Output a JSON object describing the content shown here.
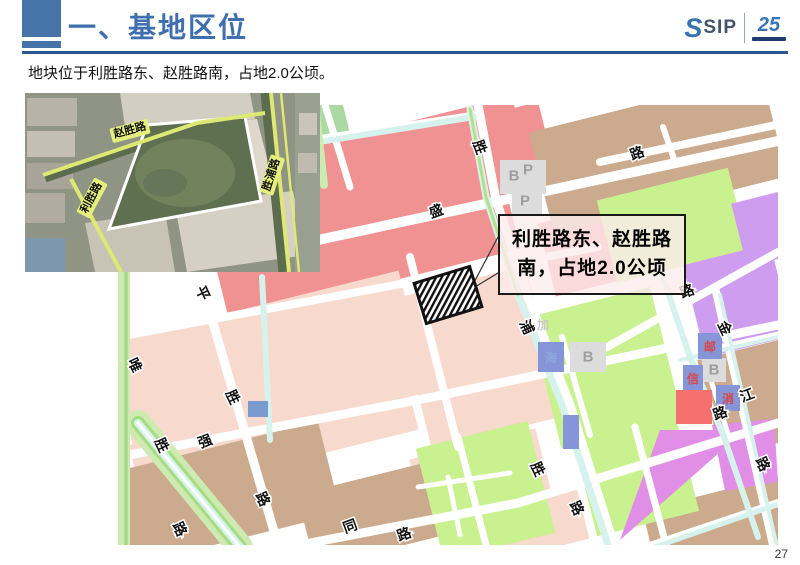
{
  "page": {
    "number": "27"
  },
  "header": {
    "title": "一、基地区位",
    "logo_sip": "SIP",
    "logo_s": "S",
    "logo_anniversary": "25"
  },
  "intro": "地块位于利胜路东、赵胜路南，占地2.0公顷。",
  "callout": {
    "line1": "利胜路东、赵胜路",
    "line2": "南，占地2.0公顷"
  },
  "colors": {
    "accent_blue": "#4673a8",
    "underline_blue": "#2e5492",
    "satellite_label_bg": "#e4ef7d"
  },
  "satellite_labels": [
    {
      "text": "赵胜路",
      "x": 105,
      "y": 38,
      "rot": -15
    },
    {
      "text": "利胜路",
      "x": 67,
      "y": 105,
      "rot": -62
    },
    {
      "text": "胜浦路",
      "x": 247,
      "y": 82,
      "rot": -72
    }
  ],
  "map_labels": {
    "roads": [
      {
        "t": "胜",
        "x": 362,
        "y": 42,
        "r": 70
      },
      {
        "t": "盛",
        "x": 318,
        "y": 106,
        "r": -20
      },
      {
        "t": "路",
        "x": 519,
        "y": 48,
        "r": -20
      },
      {
        "t": "平",
        "x": 85,
        "y": 188,
        "r": 65
      },
      {
        "t": "唯",
        "x": 17,
        "y": 260,
        "r": 65
      },
      {
        "t": "胜",
        "x": 115,
        "y": 292,
        "r": 65
      },
      {
        "t": "强",
        "x": 87,
        "y": 336,
        "r": -20
      },
      {
        "t": "胜",
        "x": 44,
        "y": 340,
        "r": 65
      },
      {
        "t": "路",
        "x": 145,
        "y": 394,
        "r": 65
      },
      {
        "t": "路",
        "x": 62,
        "y": 424,
        "r": 65
      },
      {
        "t": "同",
        "x": 232,
        "y": 421,
        "r": -20
      },
      {
        "t": "路",
        "x": 286,
        "y": 429,
        "r": -20
      },
      {
        "t": "浦",
        "x": 409,
        "y": 222,
        "r": 65
      },
      {
        "t": "胜",
        "x": 420,
        "y": 364,
        "r": 65
      },
      {
        "t": "路",
        "x": 459,
        "y": 403,
        "r": 65
      },
      {
        "t": "路",
        "x": 569,
        "y": 186,
        "r": -20
      },
      {
        "t": "金",
        "x": 607,
        "y": 223,
        "r": 65
      },
      {
        "t": "江",
        "x": 629,
        "y": 290,
        "r": -20
      },
      {
        "t": "路",
        "x": 602,
        "y": 308,
        "r": -20
      },
      {
        "t": "路",
        "x": 645,
        "y": 359,
        "r": 65
      }
    ],
    "areas": [
      {
        "t": "B",
        "x": 396,
        "y": 71
      },
      {
        "t": "P",
        "x": 410,
        "y": 65
      },
      {
        "t": "P",
        "x": 407,
        "y": 96
      },
      {
        "t": "B",
        "x": 470,
        "y": 252
      },
      {
        "t": "B",
        "x": 596,
        "y": 265
      }
    ],
    "facilities": [
      {
        "t": "邮",
        "x": 592,
        "y": 242,
        "c": "#d94545"
      },
      {
        "t": "信",
        "x": 575,
        "y": 274,
        "c": "#d94545"
      },
      {
        "t": "消",
        "x": 610,
        "y": 294,
        "c": "#d94545"
      },
      {
        "t": "海",
        "x": 433,
        "y": 253,
        "c": "#8fa7dc"
      },
      {
        "t": "加",
        "x": 425,
        "y": 220,
        "c": "#c9c9c9"
      }
    ]
  }
}
